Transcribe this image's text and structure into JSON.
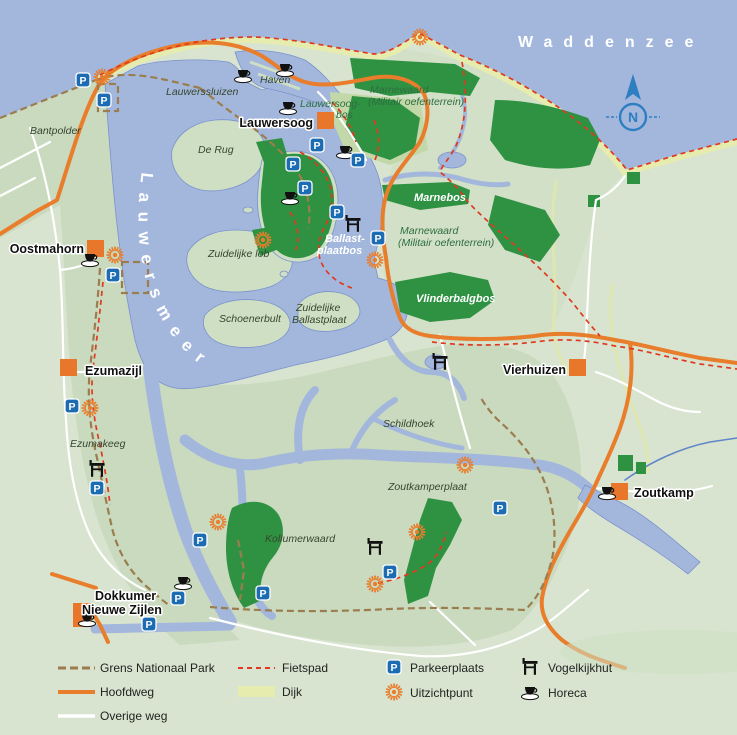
{
  "map": {
    "sea_label": "Waddenzee",
    "lake_label": "Lauwersmeer",
    "compass_letter": "N",
    "parking_letter": "P",
    "towns": {
      "lauwersoog": "Lauwersoog",
      "oostmahorn": "Oostmahorn",
      "ezumazijl": "Ezumazijl",
      "vierhuizen": "Vierhuizen",
      "zoutkamp": "Zoutkamp",
      "dokkumer_line1": "Dokkumer",
      "dokkumer_line2": "Nieuwe Zijlen"
    },
    "areas": {
      "bantpolder": "Bantpolder",
      "lauwerssluizen": "Lauwerssluizen",
      "haven": "Haven",
      "lauwersoogbos_line1": "Lauwersoog-",
      "lauwersoogbos_line2": "bos",
      "de_rug": "De Rug",
      "marnewaard_noord_line1": "Marnewaard",
      "marnewaard_noord_line2": "(Militair oefenterrein)",
      "marnebos": "Marnebos",
      "marnewaard_zuid_line1": "Marnewaard",
      "marnewaard_zuid_line2": "(Militair oefenterrein)",
      "ballastplaatbos_line1": "Ballast-",
      "ballastplaatbos_line2": "plaatbos",
      "vlinderbalgbos": "Vlinderbalgbos",
      "zuidelijke_lob": "Zuidelijke lob",
      "schoenerbult": "Schoenerbult",
      "zuidelijke_ballastplaat_line1": "Zuidelijke",
      "zuidelijke_ballastplaat_line2": "Ballastplaat",
      "schildhoek": "Schildhoek",
      "ezumakeeg": "Ezumakeeg",
      "zoutkamperplaat": "Zoutkamperplaat",
      "kollumerwaard": "Kollumerwaard"
    }
  },
  "legend": {
    "grens": "Grens Nationaal Park",
    "hoofdweg": "Hoofdweg",
    "overige_weg": "Overige weg",
    "fietspad": "Fietspad",
    "dijk": "Dijk",
    "parkeerplaats": "Parkeerplaats",
    "uitzichtpunt": "Uitzichtpunt",
    "vogelkijkhut": "Vogelkijkhut",
    "horeca": "Horeca"
  },
  "colors": {
    "sea_water": "#a3b7dd",
    "land": "#d8e4cf",
    "park_land": "#c9dabf",
    "forest": "#2f9242",
    "dijk": "#e6ecad",
    "hoofdweg_orange": "#e87d2c",
    "fietspad_red": "#df3a20",
    "grens_brown": "#9b7d4f",
    "parking_blue": "#1c6cb3",
    "compass_blue": "#2e7ec2"
  }
}
